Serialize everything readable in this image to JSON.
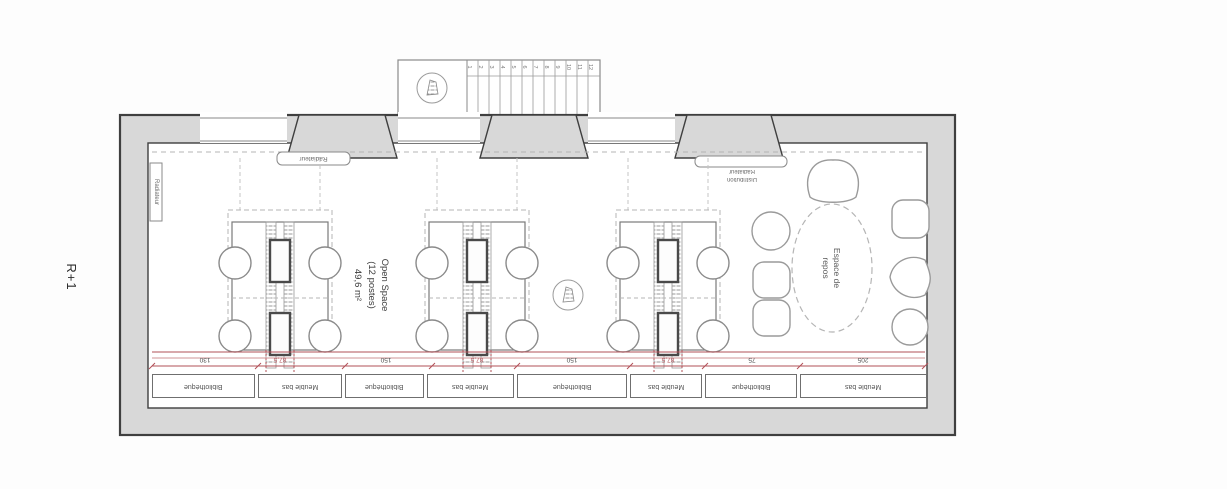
{
  "plan": {
    "floor_label": "R+1",
    "open_space": {
      "line1": "Open Space",
      "line2": "(12 postes)",
      "line3": "49,6 m²"
    },
    "rest_area": {
      "line1": "Espace de",
      "line2": "repos"
    },
    "radiators": {
      "left_wall": "Radiateur",
      "top_window": "Radiateur",
      "right_line1": "Radiateur",
      "right_line2": "Distribution"
    },
    "furniture_band": {
      "cells": [
        "Bibliothèque",
        "Meuble bas",
        "Bibliothèque",
        "Meuble bas",
        "Bibliothèque",
        "Meuble bas",
        "Bibliothèque",
        "Meuble bas"
      ]
    },
    "dimensions": [
      "130",
      "87,5",
      "150",
      "87,5",
      "150",
      "87,5",
      "75",
      "205"
    ],
    "stairs": {
      "numbers": [
        "1",
        "2",
        "3",
        "4",
        "5",
        "6",
        "7",
        "8",
        "9",
        "10",
        "11",
        "12"
      ]
    },
    "colors": {
      "wall_fill": "#d8d8d8",
      "wall_stroke": "#3f3f3f",
      "accent_red": "#b25057",
      "dash_gray": "#b5b5b5"
    }
  }
}
